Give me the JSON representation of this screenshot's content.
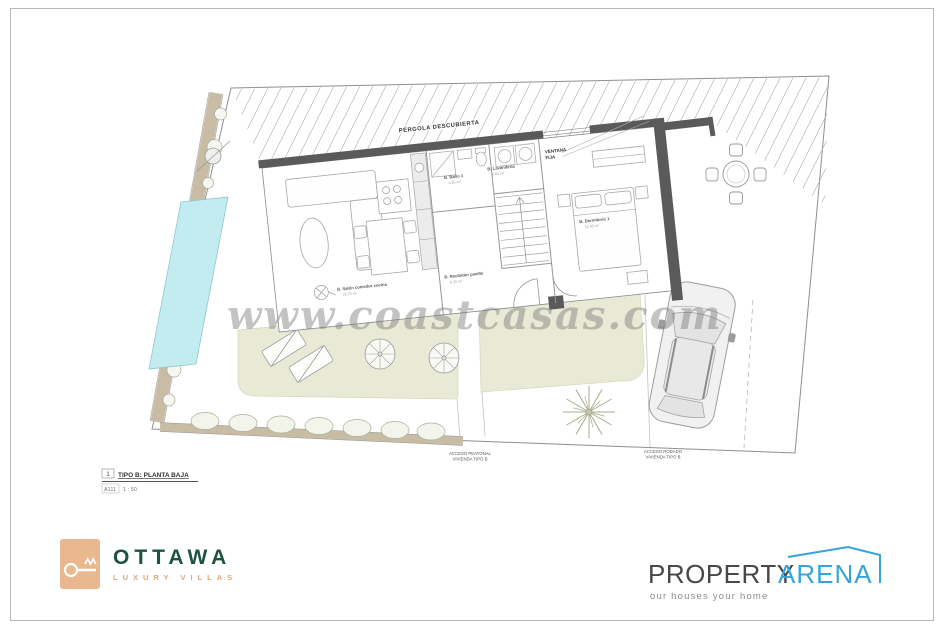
{
  "plan": {
    "pergola_label": "PÉRGOLA DESCUBIERTA",
    "window_label_line1": "VENTANA",
    "window_label_line2": "FIJA",
    "rooms": [
      {
        "name": "B. Baño 1",
        "area": "4.25 m²"
      },
      {
        "name": "B. Lavandería",
        "area": "2.60 m²"
      },
      {
        "name": "B. Dormitorio 1",
        "area": "11.45 m²"
      },
      {
        "name": "B. Salón comedor cocina",
        "area": "33.75 m²"
      },
      {
        "name": "B. Recibidor pasillo",
        "area": "6.20 m²"
      }
    ],
    "access_labels": [
      {
        "line1": "ACCESO PEATONAL",
        "line2": "VIVIENDA TIPO B"
      },
      {
        "line1": "ACCESO RODADO",
        "line2": "VIVIENDA TIPO B"
      }
    ],
    "view_title": {
      "number": "1",
      "name": "TIPO B: PLANTA BAJA",
      "sheet": "A111",
      "scale": "1 : 50"
    }
  },
  "watermark": {
    "text": "www.coastcasas.com"
  },
  "branding": {
    "ottawa": {
      "wordmark": "OTTAWA",
      "tagline": "LUXURY VILLAS"
    },
    "property_arena": {
      "word1": "PROPERTY",
      "word2": "ARENA",
      "tagline": "our houses your home"
    }
  },
  "colors": {
    "wall_dark": "#5a5a5a",
    "pool_blue": "#c3ecf1",
    "terrace_green": "#e9ead6",
    "path_tan": "#c8bca4",
    "ottawa_green": "#1d5340",
    "ottawa_tan": "#eab88f",
    "arena_blue": "#36a3da"
  }
}
